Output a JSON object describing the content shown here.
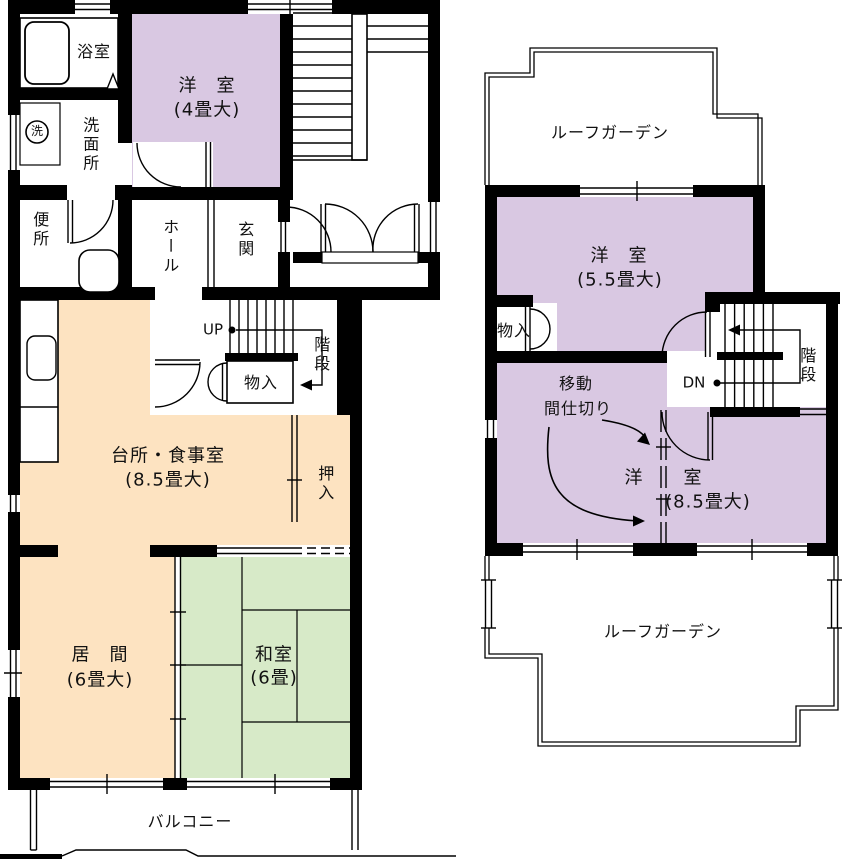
{
  "title": "間取り図",
  "colors": {
    "purple": "#d9c8e2",
    "orange": "#fde3c1",
    "green": "#d7eac8",
    "wall": "#000000",
    "line": "#000000"
  },
  "floor1": {
    "bath": "浴室",
    "washer": "洗",
    "washroom": "洗面所",
    "toilet": "便所",
    "western4": {
      "name": "洋　室",
      "size": "(4畳大)"
    },
    "hall": "ホール",
    "entrance": "玄関",
    "stairs_up": "UP",
    "stairs": "階段",
    "storage": "物入",
    "kitchen": {
      "name": "台所・食事室",
      "size": "(8.5畳大)"
    },
    "closet": "押入",
    "living": {
      "name": "居　間",
      "size": "(6畳大)"
    },
    "tatami": {
      "name": "和室",
      "size": "(6畳)"
    },
    "balcony": "バルコニー"
  },
  "floor2": {
    "roof_garden_top": "ルーフガーデン",
    "western55": {
      "name": "洋　室",
      "size": "(5.5畳大)"
    },
    "storage": "物入",
    "partition": {
      "line1": "移動",
      "line2": "間仕切り"
    },
    "western85": {
      "left": "洋",
      "right": "室",
      "size": "(8.5畳大)"
    },
    "stairs_down": "DN",
    "stairs": "階段",
    "roof_garden_bottom": "ルーフガーデン"
  }
}
